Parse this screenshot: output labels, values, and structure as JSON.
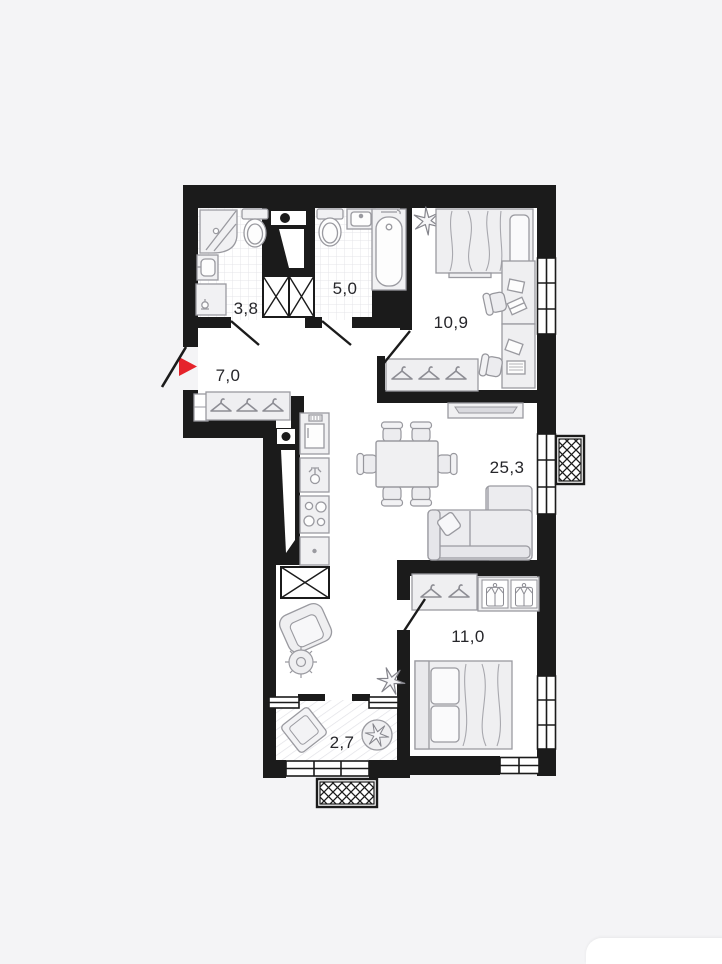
{
  "plan": {
    "wall_color": "#1b1b1b",
    "room_fill": "#ffffff",
    "background": "#f4f4f6",
    "entrance_arrow": {
      "color": "#e5232b",
      "direction": "right"
    },
    "rooms": [
      {
        "key": "bathroom_small",
        "area": "3,8"
      },
      {
        "key": "bathroom_large",
        "area": "5,0"
      },
      {
        "key": "hallway",
        "area": "7,0"
      },
      {
        "key": "bedroom_top",
        "area": "10,9"
      },
      {
        "key": "living_kitchen",
        "area": "25,3"
      },
      {
        "key": "bedroom_bottom",
        "area": "11,0"
      },
      {
        "key": "balcony",
        "area": "2,7"
      }
    ],
    "fixture_icons": [
      "corner-shower-icon",
      "toilet-icon",
      "washbasin-icon",
      "washing-machine-icon",
      "bathtub-icon",
      "fridge-icon",
      "kitchen-sink-icon",
      "stove-icon",
      "dining-table-icon",
      "chair-icon",
      "sofa-icon",
      "tv-unit-icon",
      "bed-icon",
      "desk-icon",
      "wardrobe-hanger-icon",
      "wardrobe-shirt-icon",
      "armchair-icon",
      "pouf-icon",
      "plant-icon",
      "pillow-icon",
      "vent-shaft-icon",
      "ac-basket-icon",
      "window-icon",
      "door-leaf-icon"
    ]
  }
}
